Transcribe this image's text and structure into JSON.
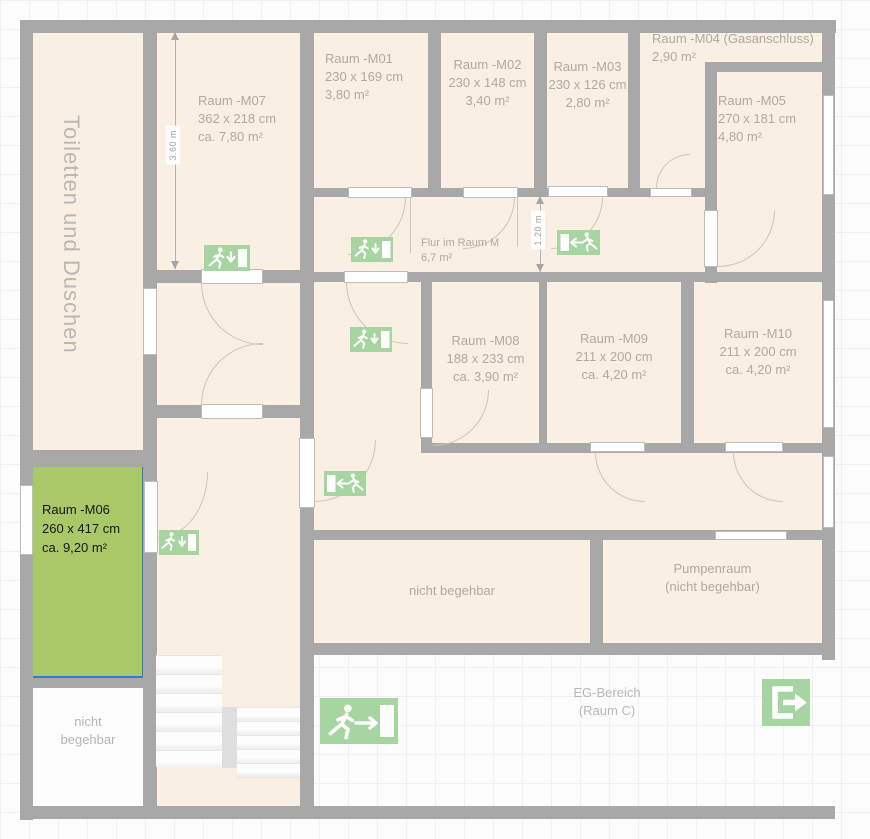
{
  "rooms": {
    "toiletten": {
      "label": "Toiletten und Duschen"
    },
    "m07": {
      "name": "Raum -M07",
      "size": "362 x 218 cm",
      "area": "ca. 7,80 m²"
    },
    "m01": {
      "name": "Raum -M01",
      "size": "230 x 169 cm",
      "area": "3,80 m²"
    },
    "m02": {
      "name": "Raum -M02",
      "size": "230 x 148 cm",
      "area": "3,40 m²"
    },
    "m03": {
      "name": "Raum -M03",
      "size": "230 x 126 cm",
      "area": "2,80 m²"
    },
    "m04": {
      "name": "Raum -M04 (Gasanschluss)",
      "area": "2,90 m²"
    },
    "m05": {
      "name": "Raum -M05",
      "size": "270 x 181 cm",
      "area": "4,80 m²"
    },
    "m06": {
      "name": "Raum -M06",
      "size": "260 x 417 cm",
      "area": "ca. 9,20 m²"
    },
    "m08": {
      "name": "Raum -M08",
      "size": "188 x 233 cm",
      "area": "ca. 3,90 m²"
    },
    "m09": {
      "name": "Raum -M09",
      "size": "211 x 200 cm",
      "area": "ca. 4,20 m²"
    },
    "m10": {
      "name": "Raum -M10",
      "size": "211 x 200 cm",
      "area": "ca. 4,20 m²"
    },
    "flur": {
      "name": "Flur im Raum M",
      "area": "6,7 m²"
    },
    "nicht_begehbar_left": {
      "line1": "nicht",
      "line2": "begehbar"
    },
    "nicht_begehbar_center": {
      "label": "nicht begehbar"
    },
    "pumpenraum": {
      "line1": "Pumpenraum",
      "line2": "(nicht begehbar)"
    },
    "eg_bereich": {
      "line1": "EG-Bereich",
      "line2": "(Raum C)"
    }
  },
  "dimensions": {
    "m07_depth": "3.60 m",
    "flur_width": "1.20 m"
  },
  "colors": {
    "wall": "#a8a8a8",
    "room_fill": "#f9efe2",
    "selected_fill": "#a9c868",
    "selected_border": "#2d7dd2",
    "exit_sign_green": "#a6d5a1",
    "label_gray": "#b1aaa0"
  },
  "icons": {
    "exit_down": "emergency-exit-runner-down-icon",
    "exit_left": "emergency-exit-runner-left-icon",
    "exit_right": "emergency-exit-runner-right-icon",
    "exit_door": "exit-door-arrow-icon"
  }
}
